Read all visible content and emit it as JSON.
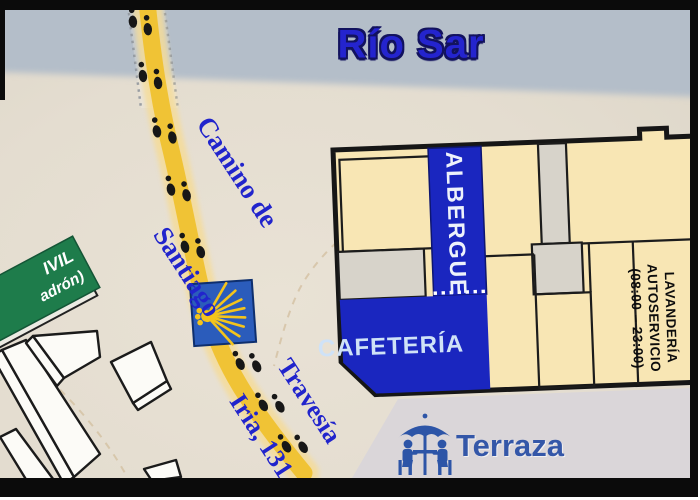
{
  "river": {
    "label": "Río Sar"
  },
  "camino": {
    "top_label_line1": "Camino de",
    "top_label_line2": "Santiago",
    "bottom_label_line1": "Travesía",
    "bottom_label_line2": "Iria, 131"
  },
  "building": {
    "albergue_label": "ALBERGUE",
    "cafeteria_label": "CAFETERÍA",
    "laundry_line1": "LAVANDERÍA",
    "laundry_line2": "AUTOSERVICIO",
    "laundry_line3": "(08:00 – 23:00)"
  },
  "terrace": {
    "label": "Terraza"
  },
  "road_sign": {
    "line1": "IVIL",
    "line2": "adrón)"
  },
  "icons": {
    "waymark": "camino-scallop-shell-waymark",
    "terrace": "table-umbrella-people-icon",
    "footprints": "footsteps-icon"
  },
  "colors": {
    "river": "#b4bec9",
    "ground": "#e4ddd0",
    "path_yellow": "#f0c335",
    "building_cream": "#f8e6b4",
    "map_blue": "#1a26bf",
    "waymark_blue": "#2b5cbb",
    "shell_yellow": "#f4c41c",
    "sign_green": "#1e7c4b",
    "label_blue": "#2124cc",
    "terrace_blue": "#3457a8"
  }
}
